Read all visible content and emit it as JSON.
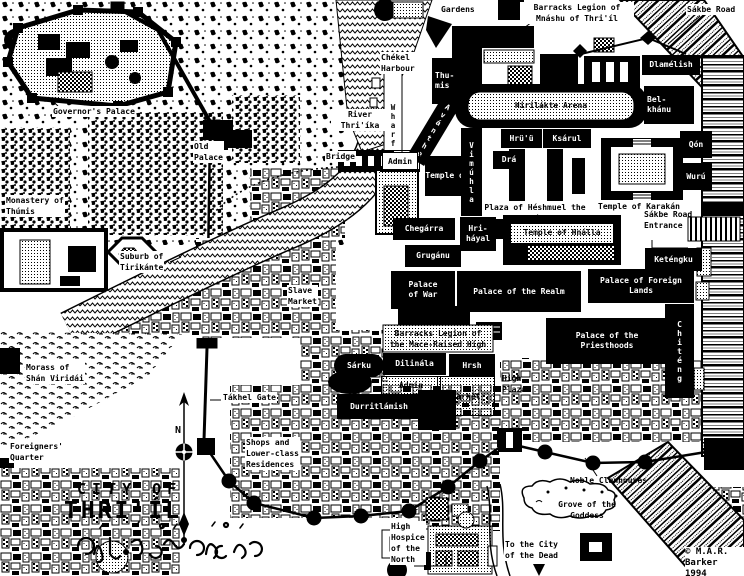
{
  "map": {
    "title": [
      "CITY OF",
      "THRI'ÍL"
    ],
    "attribution": [
      "© M.A.R.",
      "Barker 1994"
    ],
    "compass_north": "N",
    "labels": {
      "gardens": "Gardens",
      "barracks_mnashu": [
        "Barracks Legion of",
        "Mnáshu of Thri'íl"
      ],
      "sakbe_road": "Sákbe Road",
      "chekel_harbour": [
        "Chékel",
        "Harbour"
      ],
      "thumis_temple": [
        "Thu-",
        "mis"
      ],
      "wharf": "Wharf",
      "avanthe": "Avánthe",
      "governors_palace": "Governor's Palace",
      "river": [
        "River",
        "Thri'íka"
      ],
      "bridge": "Bridge",
      "admin_north": "Admin",
      "old_palace": [
        "Old",
        "Palace"
      ],
      "monastery": [
        "Monastery of",
        "Thúmis"
      ],
      "hirilakte_arena": "Hirilákte Arena",
      "dlamelish": "Dlamélish",
      "belkhanu": [
        "Bel-",
        "khánu"
      ],
      "hruu": "Hrü'ü",
      "dra": "Drá",
      "ksarul": "Ksárul",
      "qon": "Qón",
      "wuru": "Wurú",
      "temple_of": "Temple of",
      "vimuhla": "Vimúhla",
      "temple_karakan": "Temple of Karakán",
      "plaza_heshmuel": [
        "Plaza of Héshmuel the",
        "Glorious"
      ],
      "sakbe_entrance": [
        "Sákbe Road",
        "Entrance"
      ],
      "chegarra": "Chegárra",
      "hrihayal": [
        "Hri-",
        "háyal"
      ],
      "gruganu": "Grugánu",
      "temple_hnalla": "Temple of Hnálla",
      "ketengku": "Keténgku",
      "suburb_tirikante": [
        "Suburb of",
        "Tirikánte"
      ],
      "slave_market": [
        "Slave",
        "Market"
      ],
      "palace_war": [
        "Palace",
        "of War"
      ],
      "palace_realm": "Palace of the Realm",
      "palace_foreign": [
        "Palace of Foreign",
        "Lands"
      ],
      "chiteng": "Chiténg",
      "barracks_mace": [
        "Barracks Legion of",
        "the Mace-Raised High"
      ],
      "palace_priesthoods": [
        "Palace of the",
        "Priesthoods"
      ],
      "sarku": "Sárku",
      "dilinala": "Dilinála",
      "hrsh": "Hrsh",
      "admin_south": "Admin",
      "market": "Market",
      "durritlamish": "Durritlámish",
      "high_plaza": [
        "High",
        "Plaza"
      ],
      "morass": [
        "Morass of",
        "Shán Viridái"
      ],
      "takhel_gate": "Tákhel Gate",
      "shops": [
        "Shops and",
        "Lower-class",
        "Residences"
      ],
      "foreigners": [
        "Foreigners'",
        "Quarter"
      ],
      "hospice": [
        "High",
        "Hospice",
        "of the",
        "North"
      ],
      "city_of_dead": [
        "To the City",
        "of the Dead"
      ],
      "noble_clanhouses": "Noble Clanhouses",
      "grove": [
        "Grove of the",
        "Goddess"
      ]
    }
  }
}
